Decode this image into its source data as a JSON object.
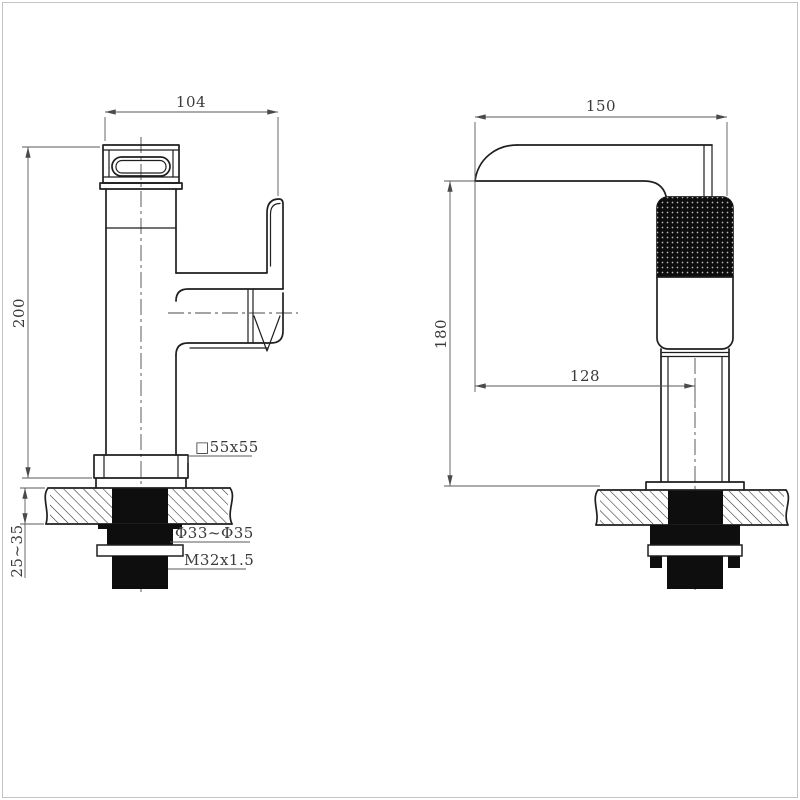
{
  "page": {
    "background": "#ffffff",
    "frame_color": "#c4c4c4",
    "outline_color": "#1f1f1f",
    "dimension_line_color": "#5a5a5a",
    "text_color": "#3a3a3a"
  },
  "front_view": {
    "width_dim": "104",
    "height_dim": "200",
    "counter_thickness_dim": "25~35",
    "base_label": "□55x55",
    "hole_label": "Φ33~Φ35",
    "thread_label": "M32x1.5"
  },
  "side_view": {
    "width_dim": "150",
    "height_dim": "180",
    "reach_dim": "128"
  }
}
